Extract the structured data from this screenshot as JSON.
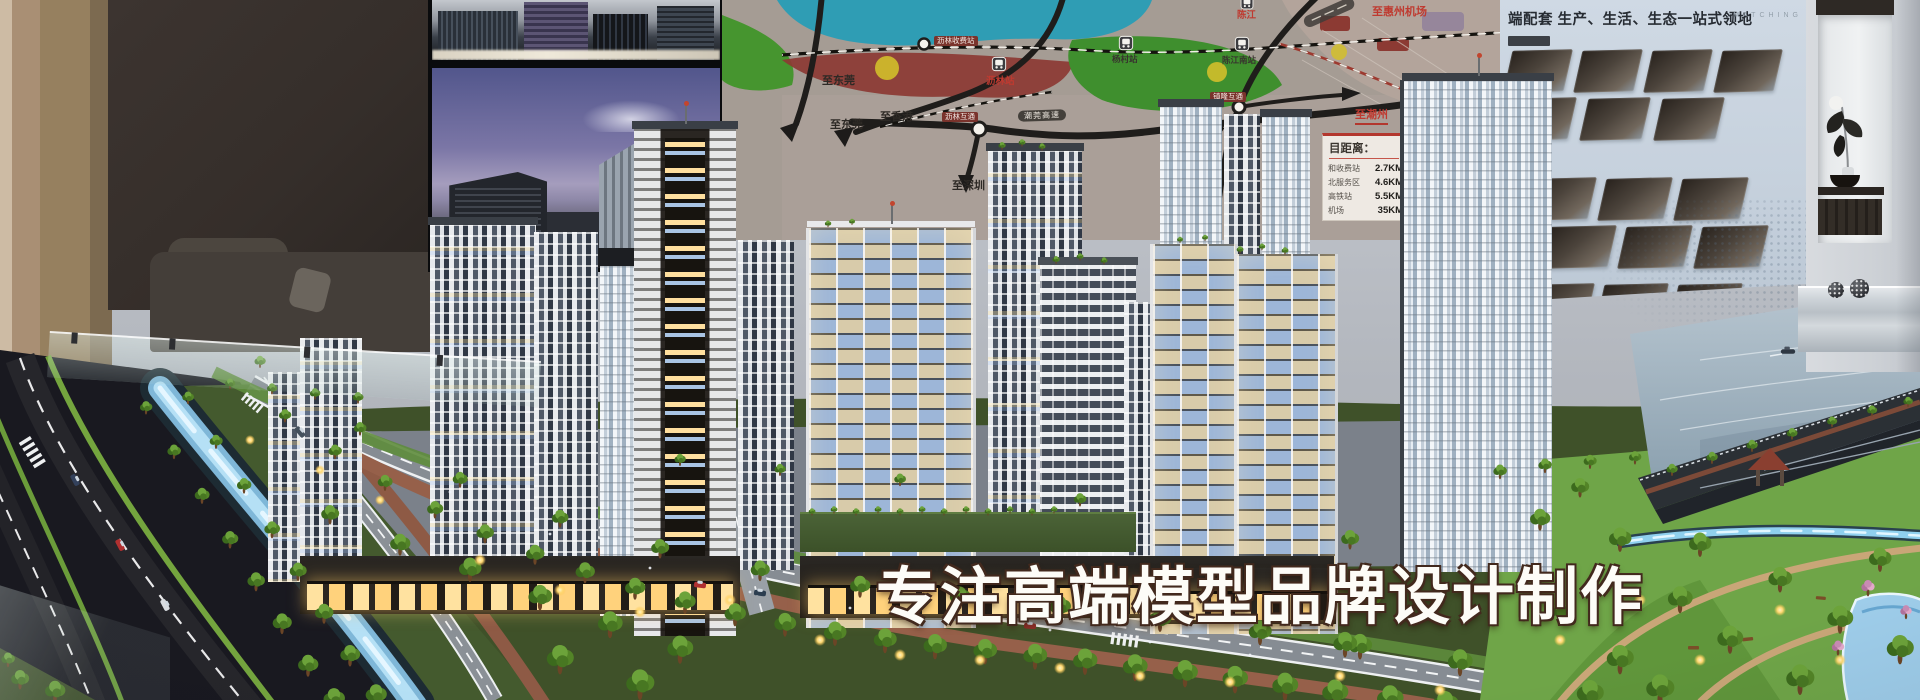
{
  "overlay": {
    "title": "专注高端模型品牌设计制作"
  },
  "map_board": {
    "labels": {
      "to_dongguan_upper": "至东莞",
      "to_dongguan_lower": "至东莞",
      "to_hongkong": "至香港",
      "to_shenzhen": "至深圳",
      "to_huizhou_airport": "至惠州机场",
      "to_chaozhou": "至潮州",
      "chenjiang": "陈江",
      "lilin_station": "沥林站",
      "yangcun_station": "杨村站",
      "chenjiang_south_station": "陈江南站",
      "lilin_toll_station": "沥林收费站",
      "lilin_interchange": "沥林互通",
      "zhenlong_interchange": "镇隆互通",
      "expressway_pill": "潮莞高速"
    },
    "distance_panel": {
      "title": "目距离：",
      "rows": [
        {
          "label": "和收费站",
          "value": "2.7KM"
        },
        {
          "label": "北服务区",
          "value": "4.6KM"
        },
        {
          "label": "高铁站",
          "value": "5.5KM"
        },
        {
          "label": "机场",
          "value": "35KM"
        }
      ]
    }
  },
  "right_poster": {
    "title": "端配套 生产、生活、生态一站式领地",
    "watermark": "MATCHING"
  },
  "icons": {
    "train_station": "train-station-icon",
    "interchange_ring": "interchange-ring-icon",
    "toll_ring": "toll-ring-icon",
    "direction_arrow": "direction-arrow-icon"
  },
  "colors": {
    "overlay_text": "#fdfcf7",
    "overlay_outline": "#42291d",
    "map_teal": "#2f9db4",
    "map_green": "#46952f",
    "map_maroon": "#8c3a33",
    "map_label_red": "#bf3a30",
    "poster_bg": "#ccd7e2",
    "canal_glow": "#aee3f7",
    "warm_light": "#ffd98a",
    "checker_tan": "#d8cbaa",
    "checker_blue": "#9db6d8",
    "tree_green": "#5c9335"
  }
}
